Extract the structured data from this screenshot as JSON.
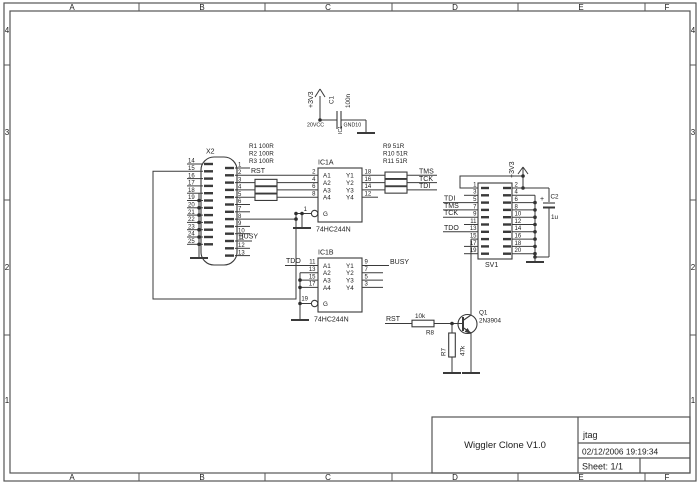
{
  "frame": {
    "columns": [
      "A",
      "B",
      "C",
      "D",
      "E",
      "F"
    ],
    "rows": [
      "4",
      "3",
      "2",
      "1"
    ]
  },
  "title_block": {
    "title": "Wiggler Clone V1.0",
    "doc": "jtag",
    "timestamp": "02/12/2006 19:19:34",
    "sheet": "Sheet: 1/1"
  },
  "power_top": {
    "rail": "+3V3",
    "cap_ref": "C1",
    "cap_value": "100n",
    "vcc_pin": "20VCC",
    "gnd_pin": "GND10",
    "gate_ref": "IC1"
  },
  "power_right": {
    "rail": "+3V3",
    "cap_ref": "C2",
    "cap_value": "1u",
    "plus": "+"
  },
  "x2": {
    "ref": "X2",
    "left_pins": [
      "14",
      "15",
      "16",
      "17",
      "18",
      "19",
      "20",
      "21",
      "22",
      "23",
      "24",
      "25"
    ],
    "right_pins": [
      "1",
      "2",
      "3",
      "4",
      "5",
      "6",
      "7",
      "8",
      "9",
      "10",
      "11",
      "12",
      "13"
    ],
    "rst": "RST",
    "busy": "BUSY"
  },
  "input_resistors": [
    "R1 100R",
    "R2 100R",
    "R3 100R"
  ],
  "output_resistors": [
    "R9  51R",
    "R10 51R",
    "R11 51R"
  ],
  "ic1a": {
    "ref": "IC1A",
    "part": "74HC244N",
    "input_names": [
      "A1",
      "A2",
      "A3",
      "A4"
    ],
    "output_names": [
      "Y1",
      "Y2",
      "Y3",
      "Y4"
    ],
    "enable_name": "G",
    "input_pins": [
      "2",
      "4",
      "6",
      "8"
    ],
    "output_pins": [
      "18",
      "16",
      "14",
      "12"
    ],
    "enable_pin": "1"
  },
  "ic1b": {
    "ref": "IC1B",
    "part": "74HC244N",
    "input_names": [
      "A1",
      "A2",
      "A3",
      "A4"
    ],
    "output_names": [
      "Y1",
      "Y2",
      "Y3",
      "Y4"
    ],
    "enable_name": "G",
    "input_pins": [
      "11",
      "13",
      "15",
      "17"
    ],
    "output_pins": [
      "9",
      "7",
      "5",
      "3"
    ],
    "enable_pin": "19",
    "tdo": "TDO",
    "busy": "BUSY"
  },
  "nets_out": {
    "tms": "TMS",
    "tck": "TCK",
    "tdi": "TDI"
  },
  "sv1": {
    "ref": "SV1",
    "left_pins": [
      "1",
      "3",
      "5",
      "7",
      "9",
      "11",
      "13",
      "15",
      "17",
      "19"
    ],
    "right_pins": [
      "2",
      "4",
      "6",
      "8",
      "10",
      "12",
      "14",
      "16",
      "18",
      "20"
    ],
    "tdi": "TDI",
    "tms": "TMS",
    "tck": "TCK",
    "tdo": "TDO"
  },
  "q1": {
    "ref": "Q1",
    "part": "2N3904"
  },
  "r8": {
    "ref": "R8",
    "value": "10k"
  },
  "r7": {
    "ref": "R7",
    "value": "47k"
  },
  "rst_bottom": "RST"
}
